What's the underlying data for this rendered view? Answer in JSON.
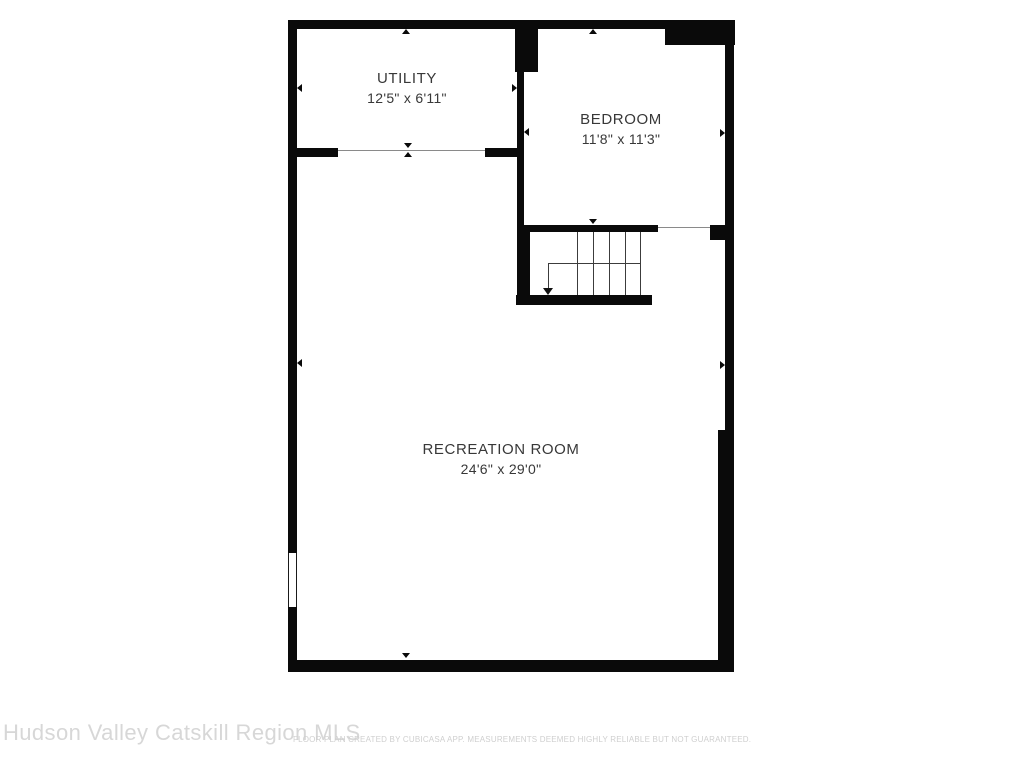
{
  "rooms": [
    {
      "name": "UTILITY",
      "dimensions": "12'5\" x 6'11\""
    },
    {
      "name": "BEDROOM",
      "dimensions": "11'8\" x 11'3\""
    },
    {
      "name": "RECREATION ROOM",
      "dimensions": "24'6\" x 29'0\""
    }
  ],
  "footer": {
    "watermark": "Hudson Valley Catskill Region MLS",
    "disclaimer": "FLOOR PLAN CREATED BY CUBICASA APP. MEASUREMENTS DEEMED HIGHLY RELIABLE BUT NOT GUARANTEED."
  },
  "icons": {
    "stair_arrow": "down-arrow",
    "wall_markers": "small-triangles-pointing-at-walls"
  },
  "colors": {
    "wall": "#0a0a0a",
    "room_label": "#383838",
    "opening_line": "#8a8a8a",
    "stair_line": "#3c3c3c",
    "watermark": "#d7d7d7",
    "disclaimer": "#cfcfcf",
    "background": "#ffffff"
  }
}
